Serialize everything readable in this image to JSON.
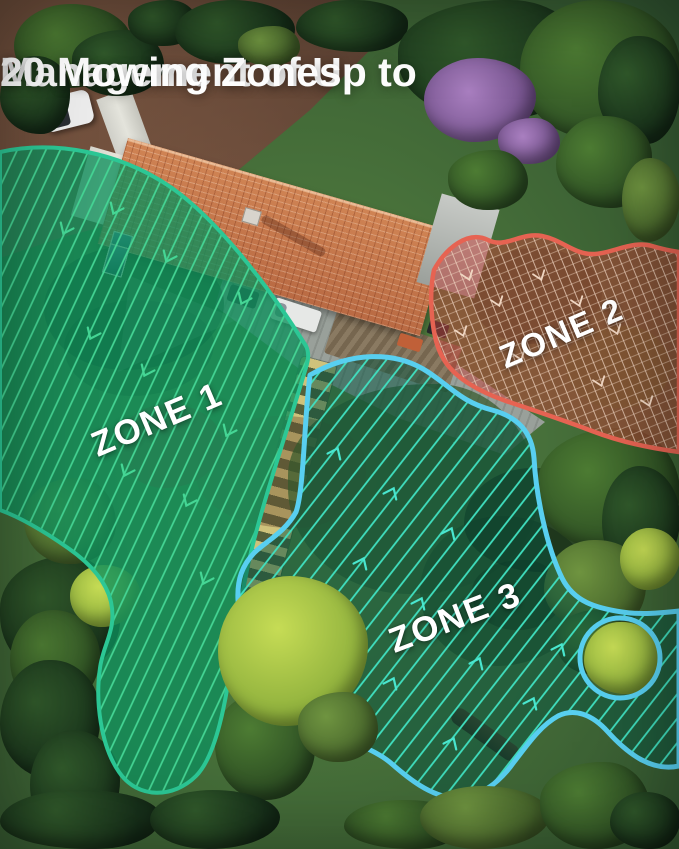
{
  "headline": {
    "line1": "Management of Up to",
    "line2": "20 Mowing Zones",
    "text_color": "#ffffff"
  },
  "zones": [
    {
      "label": "ZONE 1",
      "border_color": "#2cc795",
      "stripe_color": "#45d695",
      "fill_color": "rgba(14,143,92,0.78)"
    },
    {
      "label": "ZONE 2",
      "border_color": "#e66352",
      "stripe_color": "#f0d6c2",
      "fill_color": "rgba(196,64,56,0.50)"
    },
    {
      "label": "ZONE 3",
      "border_color": "#58cff0",
      "stripe_color": "#40e0c0",
      "fill_color": "rgba(8,84,66,0.52)"
    }
  ]
}
